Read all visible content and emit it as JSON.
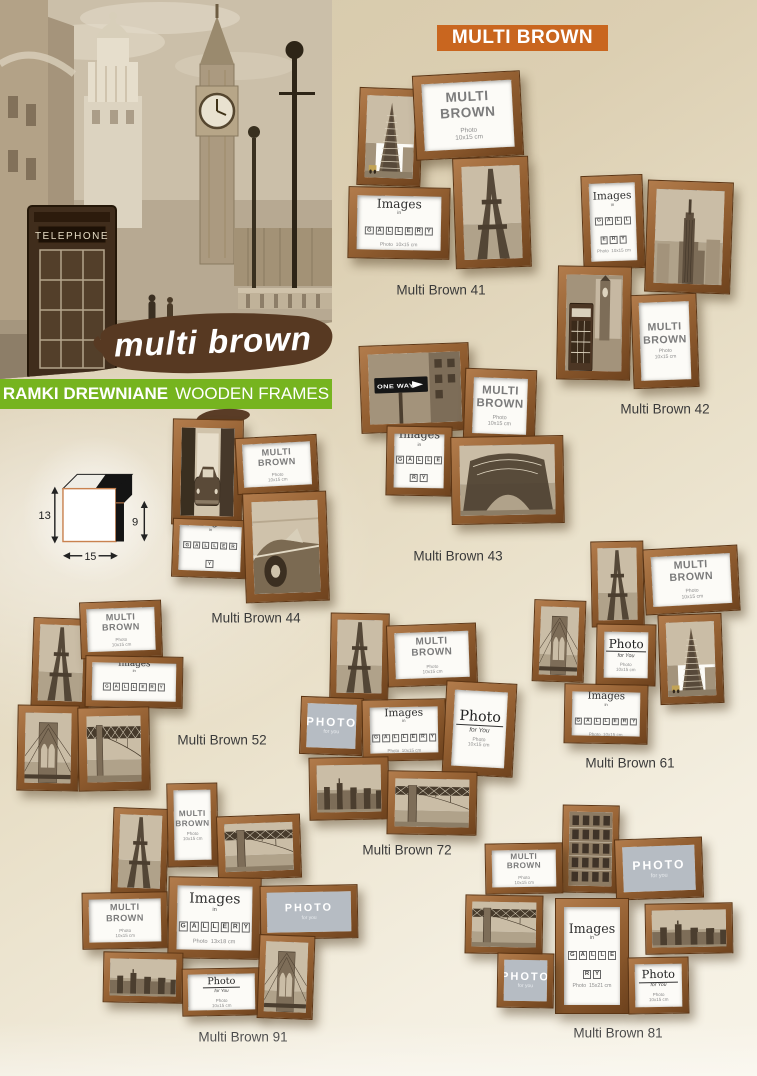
{
  "page": {
    "badge_label": "MULTI BROWN",
    "script_title": "multi brown",
    "banner_bold": "RAMKI DREWNIANE",
    "banner_regular": "WOODEN FRAMES",
    "hero": {
      "telephone_sign": "TELEPHONE"
    },
    "accent_colors": {
      "orange": "#c9661f",
      "green": "#76b41f",
      "brush_brown": "#5a3c26",
      "wood": "#8a5630"
    }
  },
  "profile_diagram": {
    "height_cm": "13",
    "rabbet_cm": "9",
    "width_cm": "15"
  },
  "inserts": {
    "multi_brown": {
      "line1": "MULTI",
      "line2": "BROWN",
      "sub1": "Photo",
      "sub2": "10x15 cm"
    },
    "images": {
      "title": "Images",
      "mid": "in",
      "tiles": "GALLERY",
      "sub1": "Photo",
      "sub2": "10x15 cm"
    },
    "photo_white": {
      "title": "Photo",
      "mid": "for You",
      "sub1": "Photo",
      "sub2": "10x15 cm"
    },
    "photo_gray": {
      "title": "PHOTO",
      "mid": "for you"
    }
  },
  "photo_text": {
    "one_way_sign": "ONE WAY"
  },
  "products": [
    {
      "label": "Multi Brown 41",
      "x": 348,
      "y": 73,
      "w": 182,
      "h": 197,
      "label_x": 441,
      "label_y": 290,
      "frames": [
        {
          "kind": "photo",
          "photo": "flatiron",
          "x": 10,
          "y": 15,
          "w": 64,
          "h": 98,
          "rot": 2
        },
        {
          "kind": "multi_brown",
          "x": 66,
          "y": 0,
          "w": 108,
          "h": 85,
          "rot": -3
        },
        {
          "kind": "images",
          "x": 0,
          "y": 114,
          "w": 102,
          "h": 72,
          "rot": 1
        },
        {
          "kind": "photo",
          "photo": "eiffel",
          "x": 106,
          "y": 84,
          "w": 76,
          "h": 111,
          "rot": -2
        }
      ]
    },
    {
      "label": "Multi Brown 42",
      "x": 556,
      "y": 170,
      "w": 192,
      "h": 220,
      "label_x": 665,
      "label_y": 409,
      "frames": [
        {
          "kind": "images",
          "x": 26,
          "y": 5,
          "w": 62,
          "h": 94,
          "rot": -2
        },
        {
          "kind": "photo",
          "photo": "empire",
          "x": 90,
          "y": 11,
          "w": 86,
          "h": 112,
          "rot": 2
        },
        {
          "kind": "photo",
          "photo": "phonebox",
          "x": 1,
          "y": 96,
          "w": 74,
          "h": 114,
          "rot": 1
        },
        {
          "kind": "multi_brown",
          "x": 76,
          "y": 124,
          "w": 66,
          "h": 94,
          "rot": -2
        }
      ]
    },
    {
      "label": "Multi Brown 43",
      "x": 358,
      "y": 328,
      "w": 206,
      "h": 212,
      "label_x": 458,
      "label_y": 556,
      "frames": [
        {
          "kind": "photo",
          "photo": "oneway",
          "x": 2,
          "y": 16,
          "w": 110,
          "h": 88,
          "rot": -2
        },
        {
          "kind": "multi_brown",
          "x": 106,
          "y": 41,
          "w": 72,
          "h": 74,
          "rot": 2
        },
        {
          "kind": "images",
          "x": 28,
          "y": 98,
          "w": 66,
          "h": 70,
          "rot": 1
        },
        {
          "kind": "photo",
          "photo": "eiffel_base",
          "x": 93,
          "y": 108,
          "w": 113,
          "h": 88,
          "rot": -1
        }
      ]
    },
    {
      "label": "Multi Brown 44",
      "x": 158,
      "y": 417,
      "w": 172,
      "h": 190,
      "label_x": 256,
      "label_y": 618,
      "frames": [
        {
          "kind": "photo",
          "photo": "car_alley",
          "x": 14,
          "y": 2,
          "w": 71,
          "h": 106,
          "rot": 1
        },
        {
          "kind": "multi_brown",
          "x": 78,
          "y": 19,
          "w": 82,
          "h": 57,
          "rot": -3
        },
        {
          "kind": "images",
          "x": 14,
          "y": 102,
          "w": 76,
          "h": 59,
          "rot": 2
        },
        {
          "kind": "photo",
          "photo": "classic_car",
          "x": 86,
          "y": 75,
          "w": 84,
          "h": 110,
          "rot": -2
        }
      ]
    },
    {
      "label": "Multi Brown 52",
      "x": 14,
      "y": 598,
      "w": 245,
      "h": 195,
      "label_x": 222,
      "label_y": 740,
      "frames": [
        {
          "kind": "photo",
          "photo": "eiffel",
          "x": 18,
          "y": 20,
          "w": 58,
          "h": 90,
          "rot": 2
        },
        {
          "kind": "multi_brown",
          "x": 66,
          "y": 3,
          "w": 82,
          "h": 57,
          "rot": -2
        },
        {
          "kind": "images",
          "x": 71,
          "y": 58,
          "w": 98,
          "h": 52,
          "rot": 1
        },
        {
          "kind": "photo",
          "photo": "brooklyn",
          "x": 3,
          "y": 107,
          "w": 62,
          "h": 86,
          "rot": 1
        },
        {
          "kind": "photo",
          "photo": "bridge",
          "x": 64,
          "y": 109,
          "w": 72,
          "h": 84,
          "rot": -1
        }
      ]
    },
    {
      "label": "Multi Brown 61",
      "x": 533,
      "y": 535,
      "w": 224,
      "h": 215,
      "label_x": 630,
      "label_y": 763,
      "frames": [
        {
          "kind": "photo",
          "photo": "brooklyn",
          "x": 0,
          "y": 65,
          "w": 52,
          "h": 82,
          "rot": 2
        },
        {
          "kind": "photo",
          "photo": "eiffel",
          "x": 58,
          "y": 6,
          "w": 53,
          "h": 86,
          "rot": -1
        },
        {
          "kind": "multi_brown",
          "x": 111,
          "y": 12,
          "w": 95,
          "h": 66,
          "rot": -3
        },
        {
          "kind": "photo_white",
          "x": 63,
          "y": 89,
          "w": 60,
          "h": 62,
          "rot": 1
        },
        {
          "kind": "photo",
          "photo": "flatiron",
          "x": 126,
          "y": 79,
          "w": 64,
          "h": 90,
          "rot": -2
        },
        {
          "kind": "images",
          "x": 31,
          "y": 149,
          "w": 84,
          "h": 60,
          "rot": 1
        }
      ]
    },
    {
      "label": "Multi Brown 72",
      "x": 295,
      "y": 610,
      "w": 222,
      "h": 228,
      "label_x": 407,
      "label_y": 850,
      "frames": [
        {
          "kind": "photo",
          "photo": "eiffel",
          "x": 35,
          "y": 3,
          "w": 59,
          "h": 87,
          "rot": 1
        },
        {
          "kind": "multi_brown",
          "x": 92,
          "y": 14,
          "w": 90,
          "h": 62,
          "rot": -2
        },
        {
          "kind": "photo_gray",
          "x": 5,
          "y": 87,
          "w": 63,
          "h": 58,
          "rot": 2
        },
        {
          "kind": "images",
          "x": 67,
          "y": 89,
          "w": 84,
          "h": 62,
          "rot": -1
        },
        {
          "kind": "photo_white",
          "x": 149,
          "y": 72,
          "w": 71,
          "h": 94,
          "rot": 3
        },
        {
          "kind": "photo",
          "photo": "skyline",
          "x": 14,
          "y": 147,
          "w": 80,
          "h": 63,
          "rot": -1
        },
        {
          "kind": "photo",
          "photo": "bridge",
          "x": 92,
          "y": 161,
          "w": 90,
          "h": 64,
          "rot": 1
        }
      ]
    },
    {
      "label": "Multi Brown 91",
      "x": 78,
      "y": 783,
      "w": 282,
      "h": 250,
      "label_x": 243,
      "label_y": 1037,
      "frames": [
        {
          "kind": "photo",
          "photo": "eiffel",
          "x": 34,
          "y": 25,
          "w": 56,
          "h": 87,
          "rot": 2
        },
        {
          "kind": "multi_brown",
          "x": 89,
          "y": 0,
          "w": 51,
          "h": 84,
          "rot": -1
        },
        {
          "kind": "photo",
          "photo": "bridge",
          "x": 139,
          "y": 32,
          "w": 84,
          "h": 64,
          "rot": -2
        },
        {
          "kind": "multi_brown",
          "x": 4,
          "y": 109,
          "w": 86,
          "h": 57,
          "rot": -1
        },
        {
          "kind": "images",
          "x": 90,
          "y": 94,
          "w": 93,
          "h": 82,
          "rot": 1,
          "sub": "13x18 cm"
        },
        {
          "kind": "photo_gray",
          "x": 182,
          "y": 102,
          "w": 98,
          "h": 54,
          "rot": -1
        },
        {
          "kind": "photo",
          "photo": "skyline",
          "x": 25,
          "y": 169,
          "w": 80,
          "h": 51,
          "rot": 1
        },
        {
          "kind": "photo_white",
          "x": 104,
          "y": 185,
          "w": 79,
          "h": 48,
          "rot": -1
        },
        {
          "kind": "photo",
          "photo": "brooklyn",
          "x": 180,
          "y": 152,
          "w": 56,
          "h": 84,
          "rot": 2
        }
      ]
    },
    {
      "label": "Multi Brown 81",
      "x": 465,
      "y": 805,
      "w": 290,
      "h": 212,
      "label_x": 618,
      "label_y": 1033,
      "frames": [
        {
          "kind": "photo",
          "photo": "building",
          "x": 97,
          "y": 0,
          "w": 57,
          "h": 88,
          "rot": 1
        },
        {
          "kind": "multi_brown",
          "x": 20,
          "y": 38,
          "w": 78,
          "h": 51,
          "rot": -1
        },
        {
          "kind": "photo_gray",
          "x": 150,
          "y": 33,
          "w": 88,
          "h": 61,
          "rot": -2
        },
        {
          "kind": "photo",
          "photo": "bridge",
          "x": 0,
          "y": 90,
          "w": 78,
          "h": 59,
          "rot": 1
        },
        {
          "kind": "images",
          "x": 90,
          "y": 93,
          "w": 74,
          "h": 116,
          "rot": 0,
          "sub": "15x21 cm"
        },
        {
          "kind": "photo",
          "photo": "skyline",
          "x": 180,
          "y": 98,
          "w": 88,
          "h": 51,
          "rot": -1
        },
        {
          "kind": "photo_gray",
          "x": 32,
          "y": 148,
          "w": 57,
          "h": 55,
          "rot": 1
        },
        {
          "kind": "photo_white",
          "x": 163,
          "y": 152,
          "w": 61,
          "h": 57,
          "rot": -1
        }
      ]
    }
  ]
}
